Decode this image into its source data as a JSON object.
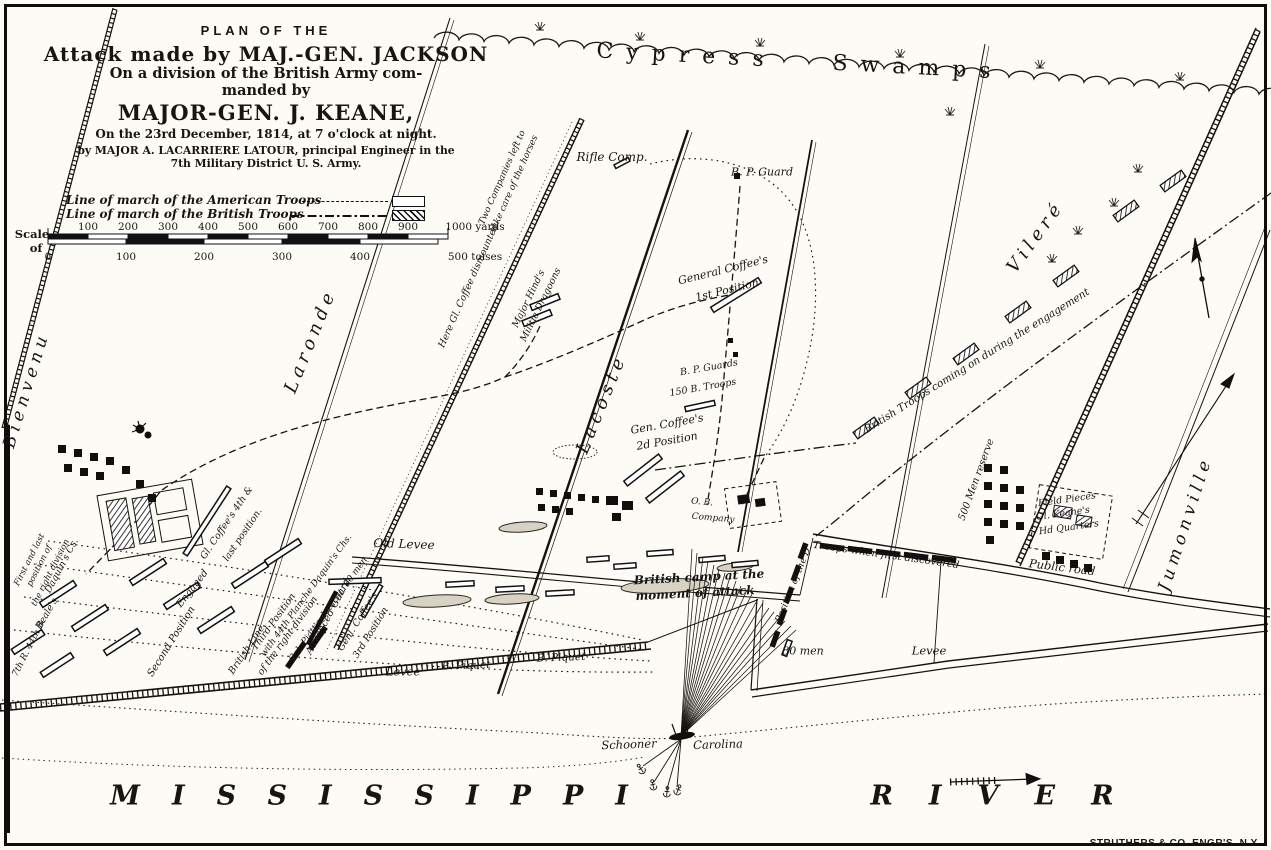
{
  "title": {
    "kicker": "PLAN OF THE",
    "line1": "Attack made by MAJ.-GEN. JACKSON",
    "line2": "On a division of the British Army com-",
    "line3": "manded by",
    "line4": "MAJOR-GEN. J. KEANE,",
    "line5": "On the 23rd December, 1814, at 7 o'clock at night.",
    "line6": "by MAJOR A. LACARRIERE LATOUR, principal Engineer in the",
    "line7": "7th Military District U. S. Army."
  },
  "legend": {
    "american": "Line of march of the American Troops",
    "british": "Line of march of the British Troops"
  },
  "scale": {
    "label1": "Scale",
    "label2": "of",
    "yards": [
      "100",
      "200",
      "300",
      "400",
      "500",
      "600",
      "700",
      "800",
      "900"
    ],
    "yards_end": "1000 yards",
    "toises": [
      "0",
      "100",
      "200",
      "300",
      "400"
    ],
    "toises_end": "500 toises"
  },
  "regions": {
    "swamps": "Cypress Swamps",
    "mississippi": "MISSISSIPPI",
    "river": "RIVER"
  },
  "plantations": {
    "bienvenu": "Bienvenu",
    "laronde": "Laronde",
    "lacoste": "Lacoste",
    "vilere": "Vileré",
    "jumonville": "Jumonville"
  },
  "labels": {
    "rifle_comp": "Rifle Comp.",
    "bp_guard": "B. P. Guard",
    "hinds1": "Major Hind's",
    "hinds2": "Militia Dragoons",
    "coffee1_a": "General Coffee's",
    "coffee1_b": "1st Position",
    "bp_guards": "B. P. Guards",
    "b150": "150 B. Troops",
    "coffee2_a": "Gen. Coffee's",
    "coffee2_b": "2d Position",
    "coffee3_a": "Genl. Coffee's",
    "coffee3_b": "3rd Position",
    "coffee4_a": "Gl. Coffee's 4th &",
    "coffee4_b": "last position.",
    "advanced_guard": "Advanced Guard",
    "second_position": "Second Position",
    "third_a": "Third Position",
    "third_b": "of the right division",
    "planche": "with 44th Planche Daquin's Chs.",
    "piatt": "Col. Piatt's detacht. 80 men",
    "british_line": "British Line",
    "engaged": "Engaged",
    "first_a": "First and last",
    "first_b": "position of",
    "first_c": "the right division",
    "r44": "7th R. 44th B.",
    "daquin": "Daquin's Cs.",
    "beale": "Beale's",
    "two_comp_a": "Two Companies left to",
    "two_comp_b": "take care of the horses",
    "dismounted": "Here Gl. Coffee dismounted",
    "coming_on": "British Troops coming on during the engagement",
    "reserve": "500 Men reserve",
    "field_pieces": "Field Pieces",
    "keane_a": "Gl. Keane's",
    "keane_b": "Hd Quarters",
    "public_road": "Public road",
    "old_levee": "Old Levee",
    "levee_left": "Levee",
    "levee_right": "Levee",
    "b_piquet1": "B. Piquet",
    "b_piquet2": "B. Piquet",
    "camp_a": "British camp at the",
    "camp_b": "moment of attack",
    "ob_a": "O. B.",
    "ob_b": "Company",
    "discovered": "Troops when first discovered",
    "position_d": "Position of the D.",
    "men80": "80 men",
    "schooner": "Schooner",
    "carolina": "Carolina"
  },
  "credit": "STRUTHERS & CO. ENGR'S. N.Y."
}
